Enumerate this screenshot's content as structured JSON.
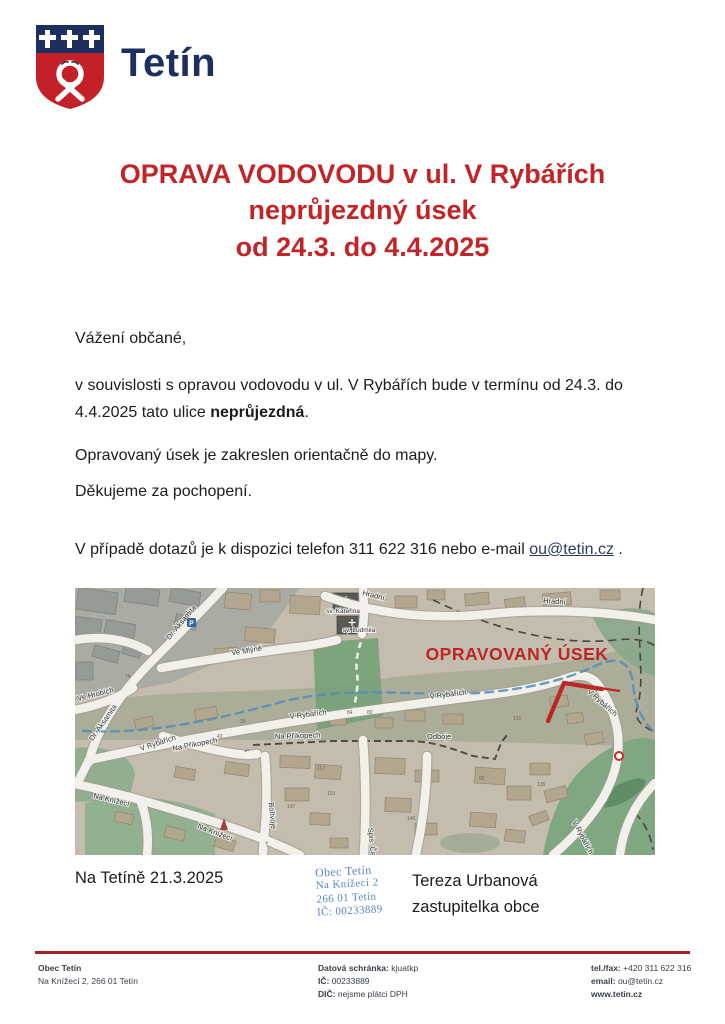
{
  "logo": {
    "title": "Tetín"
  },
  "heading": {
    "line1": "OPRAVA VODOVODU v ul. V Rybářích",
    "line2": "neprůjezdný úsek",
    "line3": "od 24.3. do 4.4.2025",
    "color": "#c22428"
  },
  "body": {
    "salutation": "Vážení občané,",
    "para1_before": "v souvislosti s opravou vodovodu v ul. V Rybářích bude v termínu od 24.3. do 4.4.2025 tato ulice ",
    "para1_bold": "neprůjezdná",
    "para1_after": ".",
    "para2": "Opravovaný úsek je zakreslen orientačně do mapy.",
    "para3": "Děkujeme za pochopení.",
    "contact_before": "V případě dotazů je k dispozici telefon 311 622 316 nebo e-mail ",
    "contact_email": "ou@tetin.cz",
    "contact_after": " ."
  },
  "map": {
    "highlight_label": "OPRAVOVANÝ ÚSEK",
    "highlight_color": "#c8201f",
    "labels": {
      "hradni_a": "Hradní",
      "hradni_b": "Hradní",
      "aksamita_a": "Dr. Aksamita",
      "aksamita_b": "Dr. Aksamita",
      "ve_mlyne": "Ve Mlýně",
      "ve_hrobich": "Ve Hrobích",
      "v_rybarich_a": "V Rybářích",
      "v_rybarich_b": "V Rybářích",
      "v_rybarich_c": "V Rybářích",
      "v_rybarich_d": "V Rybářích",
      "v_rybarich_e": "V Rybářích",
      "na_prikopech_a": "Na Příkopech",
      "na_prikopech_b": "Na Příkopech",
      "odboje": "Odboje",
      "na_knizeci_a": "Na Knížecí",
      "na_knizeci_b": "Na Knížecí",
      "borivoje": "Bořivoje",
      "spis_cervenky": "Spis. Červenky",
      "sv_katerina": "sv. Kateřina",
      "sv_ludmila": "sv. Ludmila",
      "parking": "P"
    },
    "house_numbers": {
      "n1": "74",
      "n2": "25",
      "n3": "43",
      "n4": "84",
      "n5": "80",
      "n6": "92",
      "n7": "131",
      "n8": "135",
      "n9": "147",
      "n10": "117",
      "n11": "119",
      "n12": "140"
    }
  },
  "closing": {
    "date_place": "Na Tetíně 21.3.2025",
    "signer_name": "Tereza Urbanová",
    "signer_role": "zastupitelka obce"
  },
  "stamp": {
    "line1": "Obec Tetín",
    "line2": "Na Knížecí 2",
    "line3": "266 01 Tetín",
    "line4": "IČ: 00233889"
  },
  "footer": {
    "org_name": "Obec Tetín",
    "org_address": "Na Knížecí 2, 266 01 Tetín",
    "databox_label": "Datová schránka:",
    "databox_value": " kjuatkp",
    "ic_label": "IČ:",
    "ic_value": " 00233889",
    "dic_label": "DIČ:",
    "dic_value": " nejsme plátci DPH",
    "tel_label": "tel./fax:",
    "tel_value": " +420 311 622 316",
    "email_label": "email:",
    "email_value": " ou@tetin.cz",
    "web": "www.tetin.cz",
    "rule_color": "#a81e22"
  }
}
